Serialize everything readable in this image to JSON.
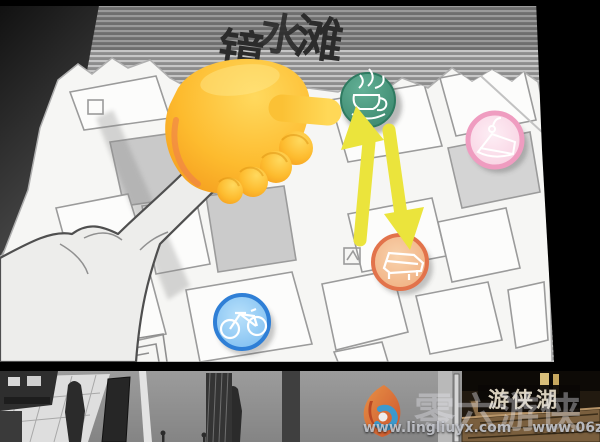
{
  "map": {
    "location_title": {
      "full": "镜水滩",
      "chars": [
        "镜",
        "水",
        "滩"
      ]
    },
    "markers": [
      {
        "name": "cafe-marker",
        "icon": "coffee-cup-icon",
        "color": "#3a8f72"
      },
      {
        "name": "cake-shop-marker",
        "icon": "cake-slice-icon",
        "color": "#f2a8c6"
      },
      {
        "name": "piano-marker",
        "icon": "grand-piano-icon",
        "color": "#e8874f"
      },
      {
        "name": "bicycle-marker",
        "icon": "bicycle-icon",
        "color": "#4a9ae0"
      }
    ],
    "swap_arrows_color": "#ebe43c",
    "cursor_icon": "pointing-hand-emoji"
  },
  "bottom_scene": {
    "sign_text": "游侠湖"
  },
  "watermark": {
    "brand": "零六游侠",
    "logo_icon": "flame-swirl-logo",
    "urls": [
      "www.lingliuyx.com",
      "www.06zyx.com"
    ]
  }
}
